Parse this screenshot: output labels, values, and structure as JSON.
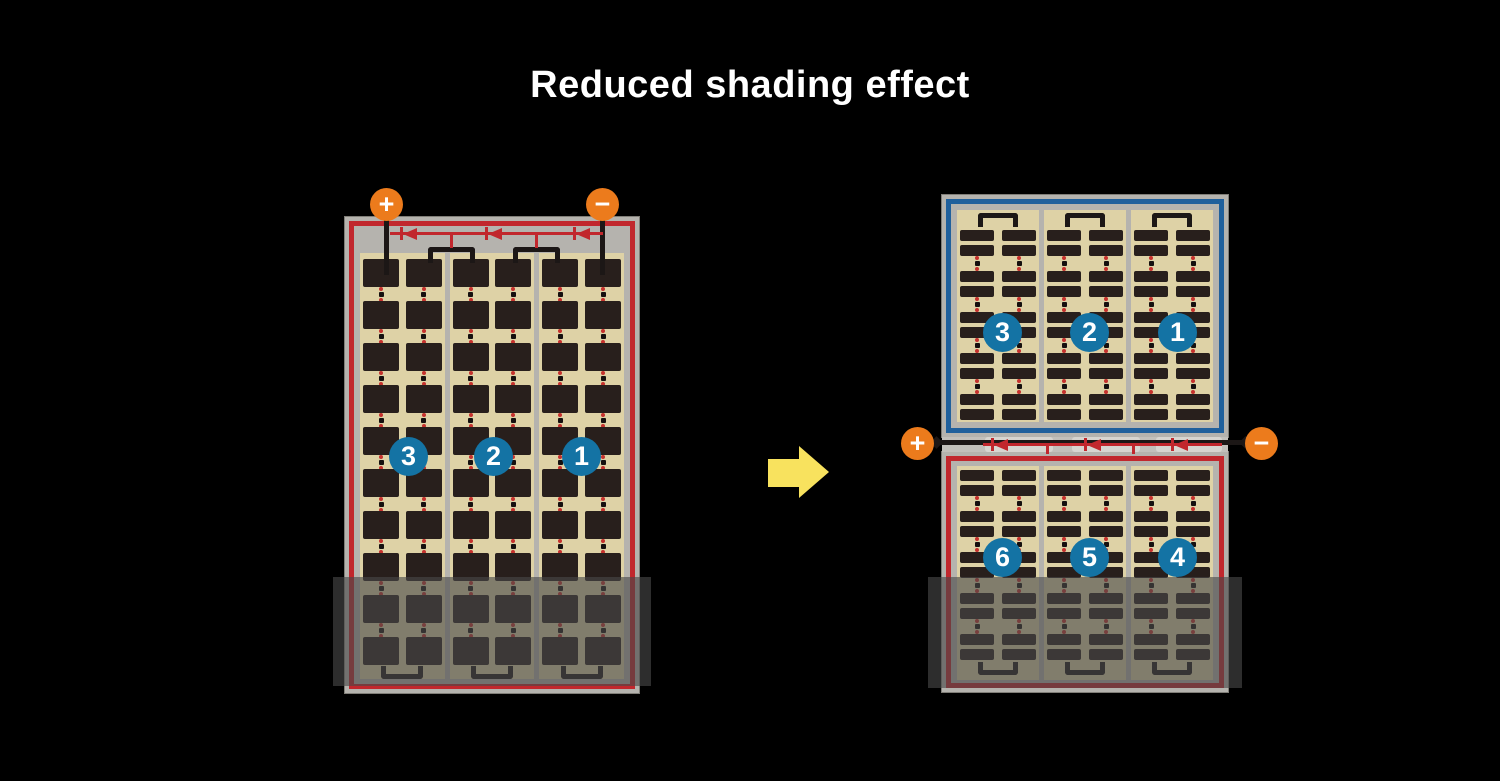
{
  "title": "Reduced shading effect",
  "colors": {
    "background": "#000000",
    "title_text": "#ffffff",
    "module_frame_gray": "#b5b3ae",
    "cell_background_tan": "#ded2a6",
    "cell_dark_brown": "#281f1c",
    "string_border_red": "#c1272d",
    "string_border_blue": "#20609c",
    "terminal_orange": "#ec7b1c",
    "number_badge_blue": "#1473a4",
    "wire_black": "#1c1716",
    "arrow_yellow": "#f8e25e",
    "shading_overlay": "rgba(72,72,72,0.62)"
  },
  "left_module": {
    "terminal_plus_label": "+",
    "terminal_minus_label": "−",
    "string_badges": [
      "3",
      "2",
      "1"
    ],
    "columns": 3,
    "cell_rows": 10,
    "bypass_diodes": 3
  },
  "right_module": {
    "terminal_plus_label": "+",
    "terminal_minus_label": "−",
    "top_half_badges": [
      "3",
      "2",
      "1"
    ],
    "bottom_half_badges": [
      "6",
      "5",
      "4"
    ],
    "columns": 3,
    "bar_row_pairs": 5,
    "bypass_diodes": 3
  }
}
